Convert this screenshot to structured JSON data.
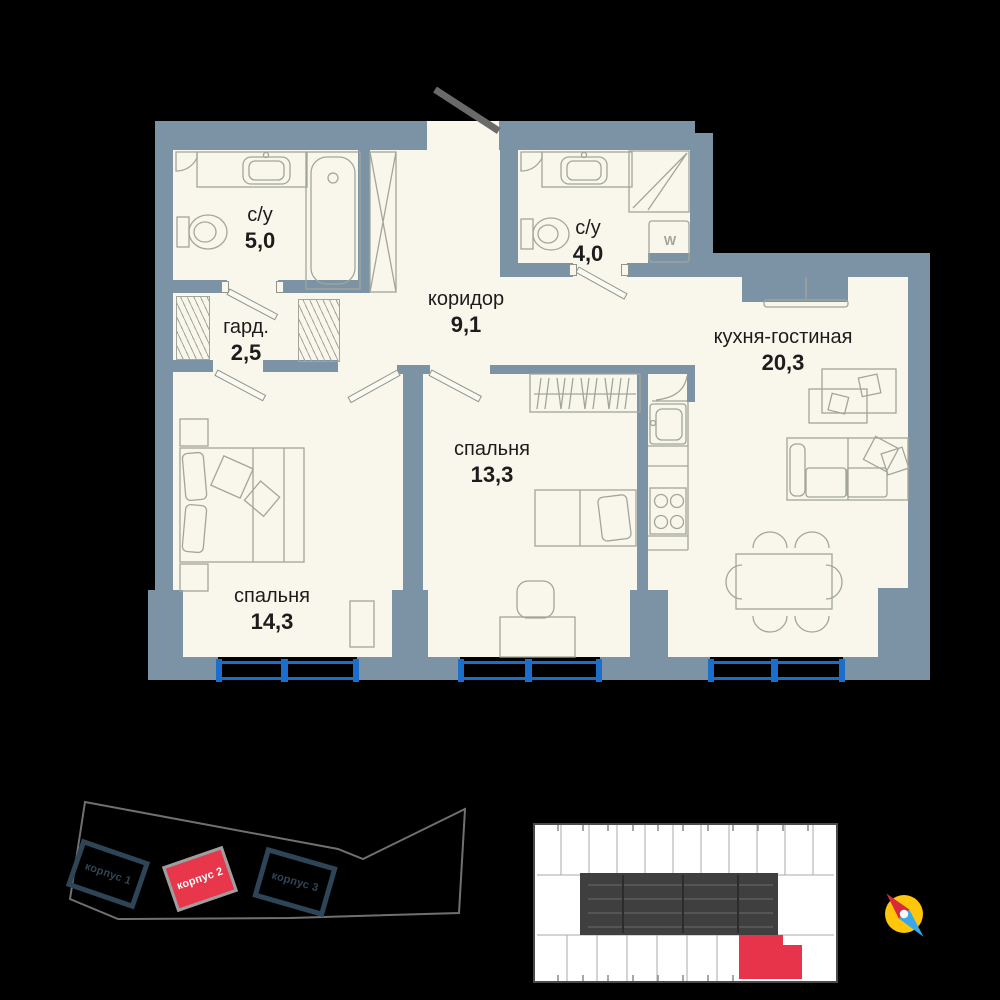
{
  "page": {
    "background": "#000000"
  },
  "floor_plan": {
    "rooms": [
      {
        "id": "bathroom-1",
        "name": "с/у",
        "area": "5,0"
      },
      {
        "id": "wardrobe",
        "name": "гард.",
        "area": "2,5"
      },
      {
        "id": "corridor",
        "name": "коридор",
        "area": "9,1"
      },
      {
        "id": "bathroom-2",
        "name": "с/у",
        "area": "4,0"
      },
      {
        "id": "kitchen-living",
        "name": "кухня-гостиная",
        "area": "20,3"
      },
      {
        "id": "bedroom-1",
        "name": "спальня",
        "area": "13,3"
      },
      {
        "id": "bedroom-2",
        "name": "спальня",
        "area": "14,3"
      }
    ],
    "washer_label": "W",
    "colors": {
      "wall": "#7b93a4",
      "floor": "#f9f7eb",
      "window": "#1b6ec9",
      "furniture_line": "#a2a69a"
    }
  },
  "site_map": {
    "buildings": [
      {
        "label": "корпус 1",
        "highlighted": false
      },
      {
        "label": "корпус 2",
        "highlighted": true
      },
      {
        "label": "корпус 3",
        "highlighted": false
      }
    ],
    "colors": {
      "highlight": "#e8364a",
      "outline": "#2e4557",
      "boundary": "#707070"
    }
  },
  "floor_overview": {
    "selected_unit_color": "#e8344a"
  },
  "compass": {
    "dial": "#ffc60a",
    "north": "#d62b3c",
    "south": "#3aa8e8"
  }
}
